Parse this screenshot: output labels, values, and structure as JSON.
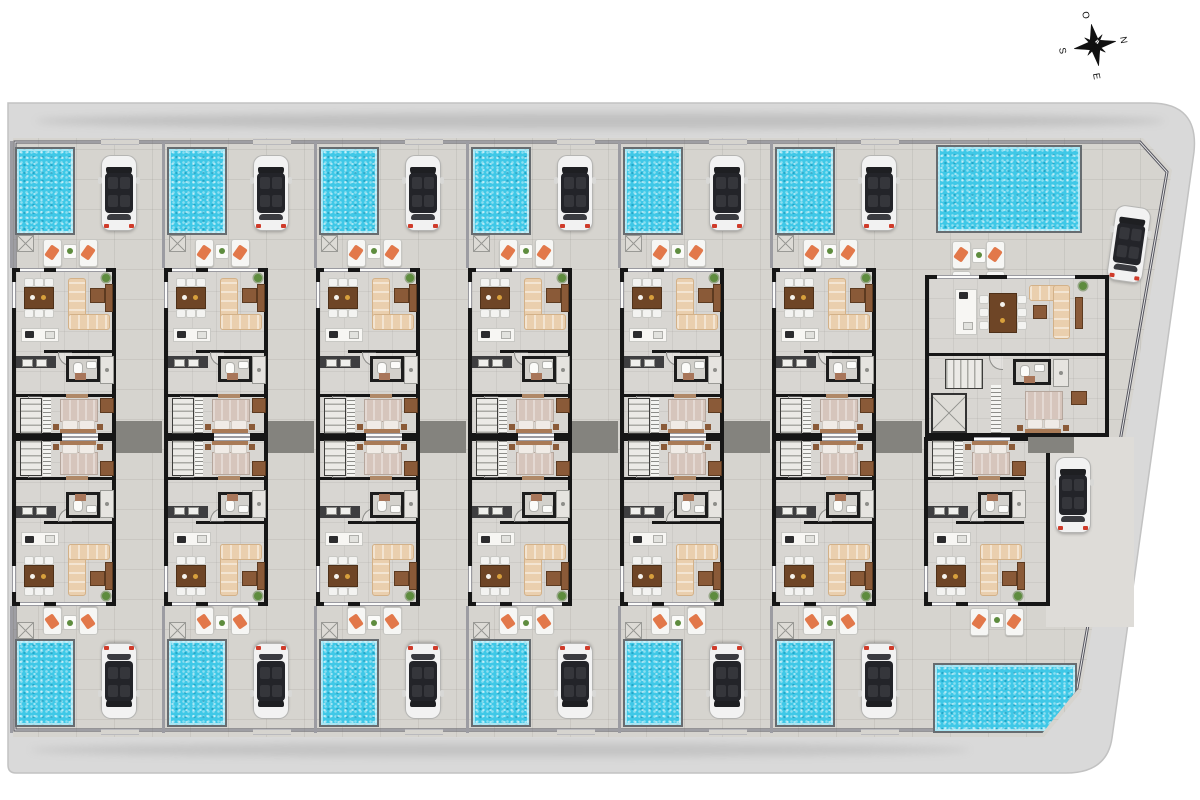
{
  "compass": {
    "north": "N",
    "east": "E",
    "south": "S",
    "west": "O",
    "rotation_deg": 80
  },
  "site": {
    "rows": 2,
    "townhouses_per_row": 6,
    "corner_villas": 2,
    "features_per_unit": [
      "swimming-pool",
      "parked-car",
      "sun-loungers",
      "living-dining",
      "kitchen",
      "bathroom",
      "stairs",
      "bedroom"
    ]
  },
  "colors": {
    "road": "#d9d9d9",
    "road_edge": "#c2c2c2",
    "ground": "#d6d4cf",
    "wall": "#161616",
    "fence": "#54545e",
    "pool_water": "#3fc8e7",
    "pool_border": "#676c70",
    "car_body": "#f2f2f2",
    "car_glass": "#1e1f22",
    "car_light": "#cf3b2a",
    "sofa": "#eacfae",
    "wood": "#8a5a38",
    "chair": "#f3f3f1",
    "island": "#f7f6f3",
    "counter": "#3e3e40",
    "bed_blanket": "#d6c5bc",
    "towel": "#e2784a",
    "plant": "#5e8c3e",
    "patio_dark": "#84837e",
    "compass_ink": "#101010"
  },
  "units": [
    {
      "id": "th-top-1",
      "type": "townhouse",
      "row": "top",
      "x": 10
    },
    {
      "id": "th-top-2",
      "type": "townhouse",
      "row": "top",
      "x": 162
    },
    {
      "id": "th-top-3",
      "type": "townhouse",
      "row": "top",
      "x": 314
    },
    {
      "id": "th-top-4",
      "type": "townhouse",
      "row": "top",
      "x": 466
    },
    {
      "id": "th-top-5",
      "type": "townhouse",
      "row": "top",
      "x": 618
    },
    {
      "id": "th-top-6",
      "type": "townhouse",
      "row": "top",
      "x": 770
    },
    {
      "id": "th-bottom-1",
      "type": "townhouse",
      "row": "bottom",
      "x": 10
    },
    {
      "id": "th-bottom-2",
      "type": "townhouse",
      "row": "bottom",
      "x": 162
    },
    {
      "id": "th-bottom-3",
      "type": "townhouse",
      "row": "bottom",
      "x": 314
    },
    {
      "id": "th-bottom-4",
      "type": "townhouse",
      "row": "bottom",
      "x": 466
    },
    {
      "id": "th-bottom-5",
      "type": "townhouse",
      "row": "bottom",
      "x": 618
    },
    {
      "id": "th-bottom-6",
      "type": "townhouse",
      "row": "bottom",
      "x": 770
    },
    {
      "id": "villa-south",
      "type": "villa",
      "row": "bottom",
      "x": 922,
      "variant": "building-only"
    },
    {
      "id": "villa-north",
      "type": "villa",
      "row": "top",
      "x": 922,
      "variant": "static"
    }
  ]
}
